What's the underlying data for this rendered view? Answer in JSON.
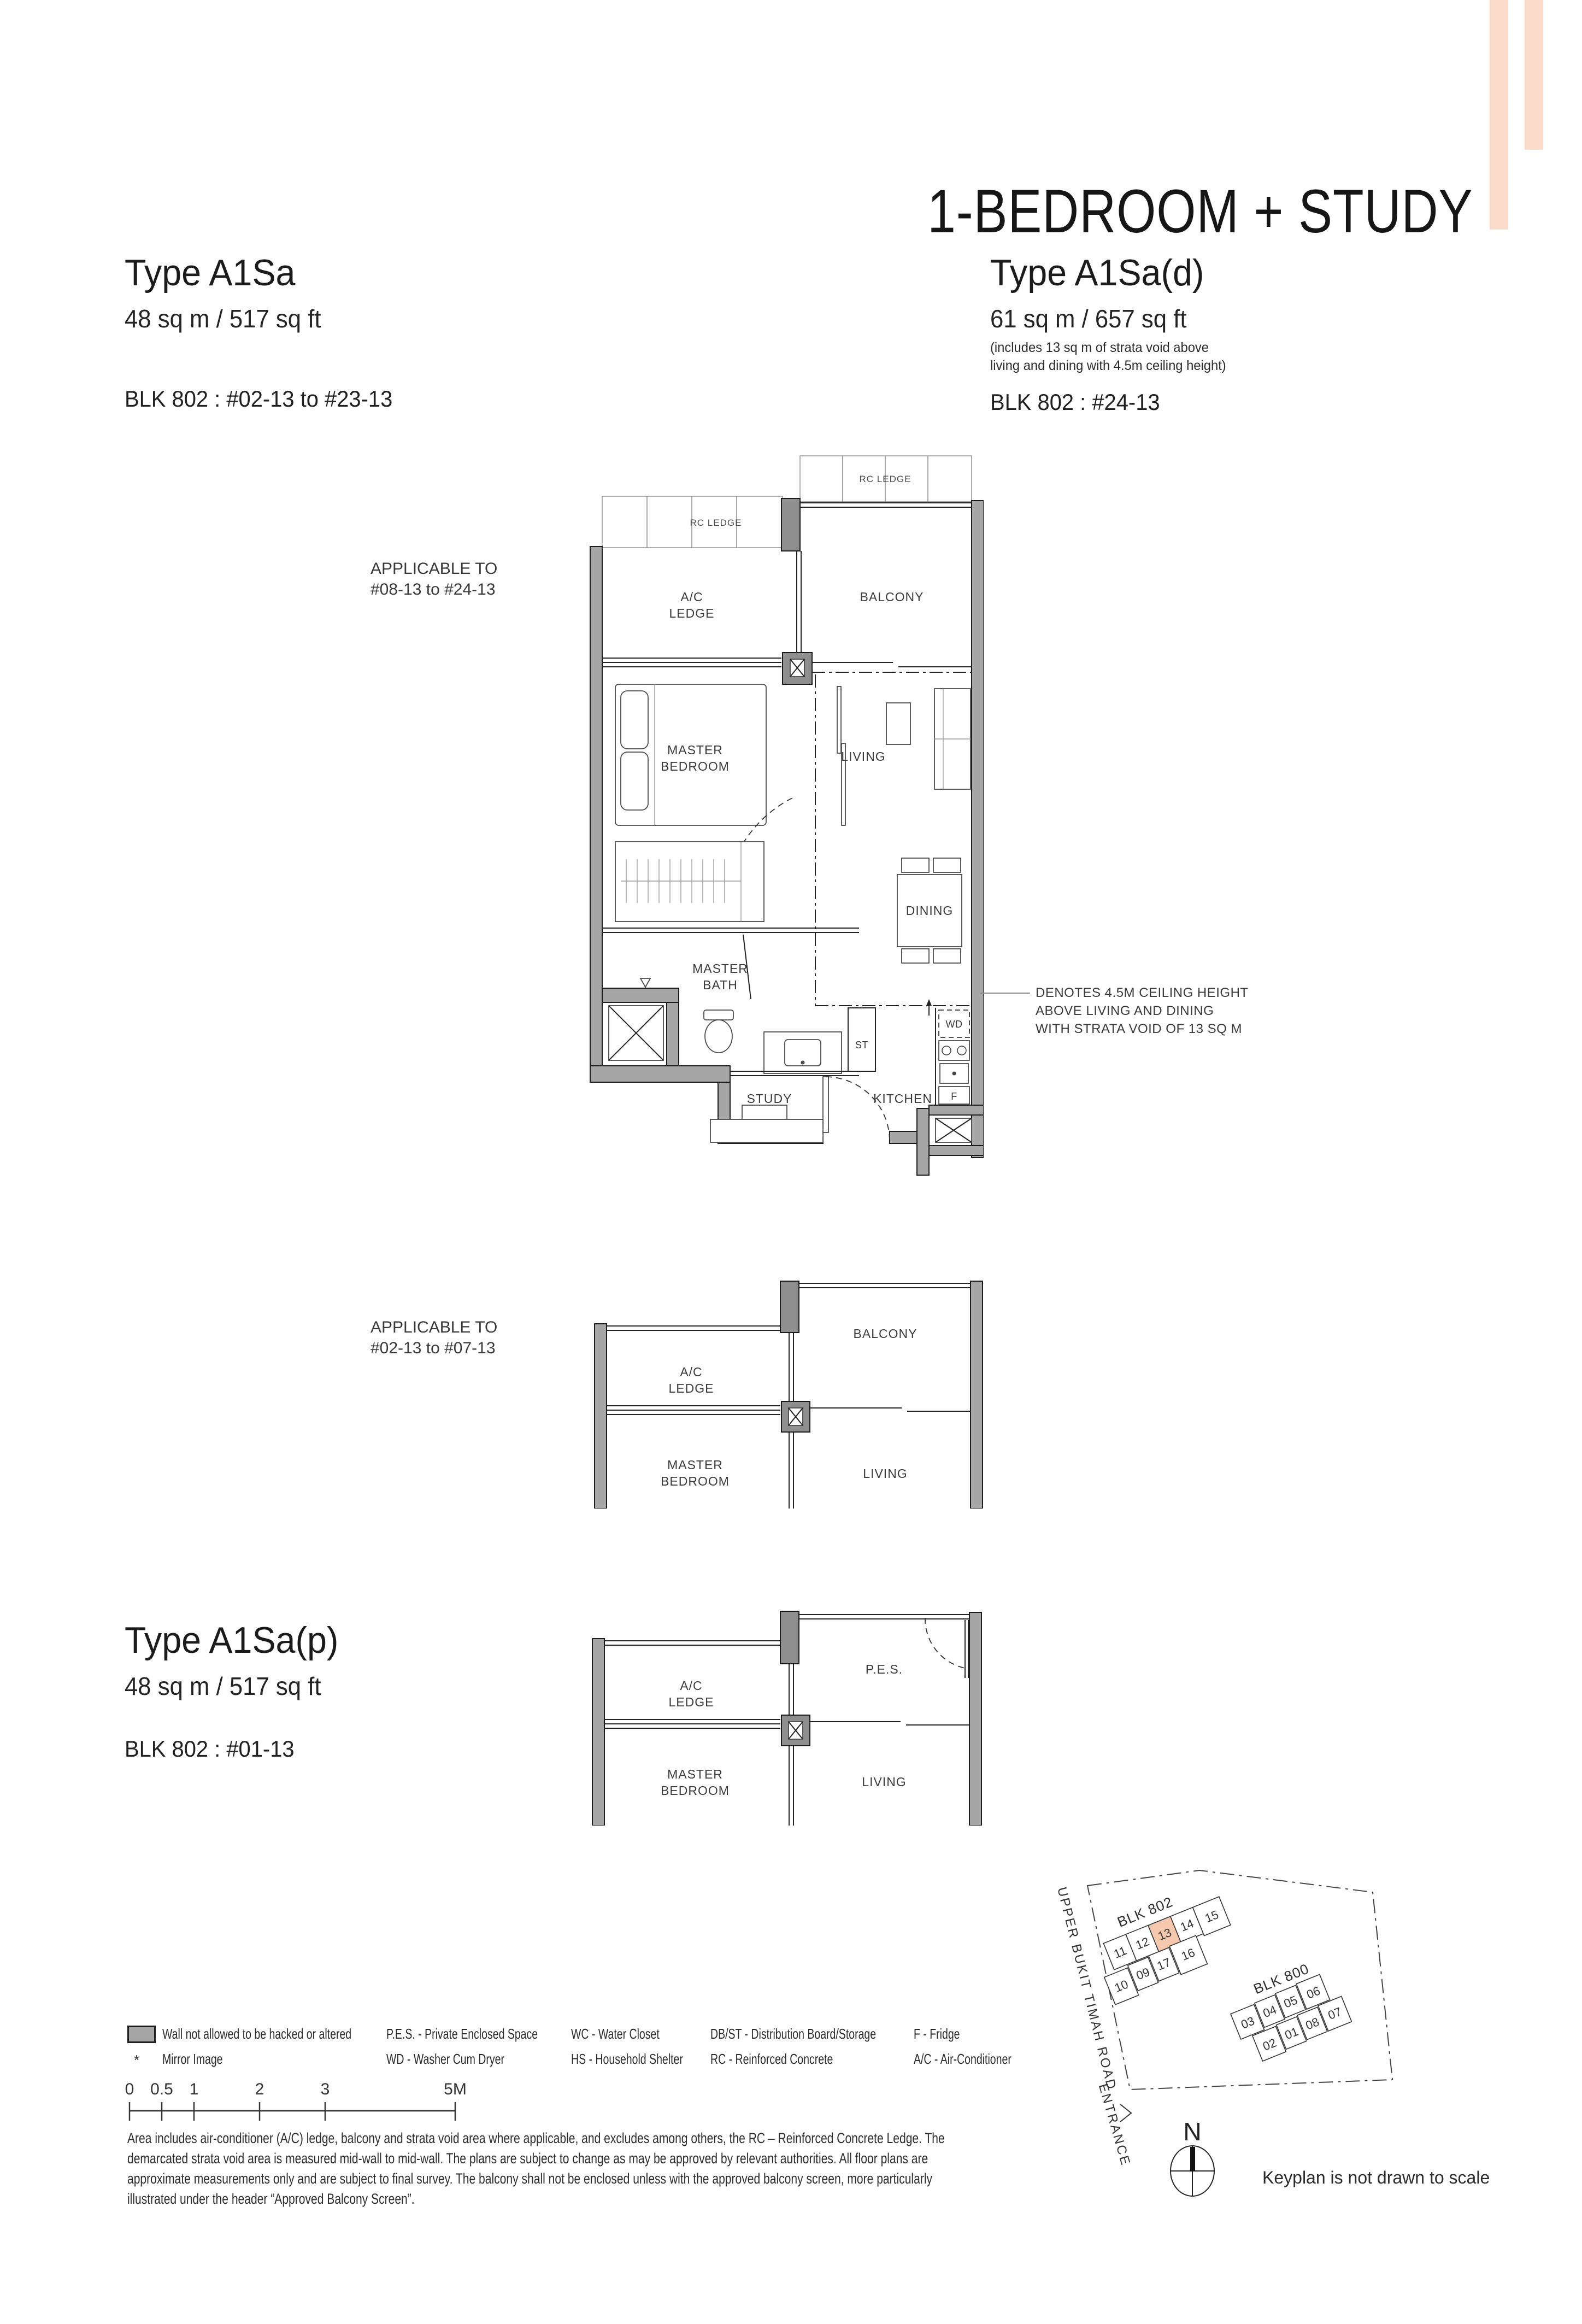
{
  "header": {
    "category_title": "1-BEDROOM + STUDY",
    "left": {
      "type": "Type A1Sa",
      "area": "48 sq m / 517 sq ft",
      "block": "BLK 802 : #02-13 to #23-13"
    },
    "right": {
      "type": "Type A1Sa(d)",
      "area": "61 sq m / 657 sq ft",
      "note1": "(includes 13 sq m of strata void above",
      "note2": "living and dining with 4.5m ceiling height)",
      "block": "BLK 802 : #24-13"
    },
    "third": {
      "type": "Type A1Sa(p)",
      "area": "48 sq m / 517 sq ft",
      "block": "BLK 802 : #01-13"
    }
  },
  "plan1": {
    "applicable1": "APPLICABLE TO",
    "applicable2": "#08-13 to #24-13",
    "rc_ledge_left": "RC LEDGE",
    "rc_ledge_right": "RC LEDGE",
    "ac1": "A/C",
    "ac2": "LEDGE",
    "balcony": "BALCONY",
    "master1": "MASTER",
    "master2": "BEDROOM",
    "living": "LIVING",
    "dining": "DINING",
    "bath1": "MASTER",
    "bath2": "BATH",
    "dbst1": "DB/",
    "dbst2": "ST",
    "wd": "WD",
    "study": "STUDY",
    "kitchen": "KITCHEN",
    "fridge": "F"
  },
  "plan2": {
    "applicable1": "APPLICABLE TO",
    "applicable2": "#02-13 to #07-13",
    "ac1": "A/C",
    "ac2": "LEDGE",
    "balcony": "BALCONY",
    "master1": "MASTER",
    "master2": "BEDROOM",
    "living": "LIVING"
  },
  "plan3": {
    "ac1": "A/C",
    "ac2": "LEDGE",
    "pes": "P.E.S.",
    "master1": "MASTER",
    "master2": "BEDROOM",
    "living": "LIVING"
  },
  "annotation": {
    "line1": "DENOTES 4.5M CEILING HEIGHT",
    "line2": "ABOVE LIVING AND DINING",
    "line3": "WITH STRATA VOID OF 13 SQ M"
  },
  "legend": {
    "wall_label": "Wall not allowed to be hacked or altered",
    "mirror_bullet": "*",
    "mirror_label": "Mirror Image",
    "pes": "P.E.S. - Private Enclosed Space",
    "wd": "WD - Washer Cum Dryer",
    "wc": "WC - Water Closet",
    "hs": "HS - Household Shelter",
    "dbst": "DB/ST - Distribution Board/Storage",
    "rc": "RC - Reinforced Concrete",
    "f": "F - Fridge",
    "ac": "A/C - Air-Conditioner"
  },
  "scalebar": {
    "t0": "0",
    "t05": "0.5",
    "t1": "1",
    "t2": "2",
    "t3": "3",
    "t5": "5M"
  },
  "disclaimer": "Area includes air-conditioner (A/C) ledge, balcony and strata void area where applicable, and excludes among others, the RC – Reinforced Concrete Ledge. The demarcated strata void area is measured mid-wall to mid-wall. The plans are subject to change as may be approved by relevant authorities. All floor plans are approximate measurements only and are subject to final survey. The balcony shall not be enclosed unless with the approved balcony screen, more particularly illustrated under the header “Approved Balcony Screen”.",
  "keyplan": {
    "blk802": "BLK 802",
    "blk800": "BLK 800",
    "u802": [
      "11",
      "12",
      "13",
      "14",
      "15",
      "10",
      "09",
      "17",
      "16"
    ],
    "u800": [
      "03",
      "04",
      "05",
      "06",
      "02",
      "01",
      "08",
      "07"
    ],
    "road": "UPPER BUKIT TIMAH ROAD",
    "entrance": "ENTRANCE",
    "north": "N",
    "note": "Keyplan is not drawn to scale",
    "highlight_color": "#f6c9ae"
  }
}
